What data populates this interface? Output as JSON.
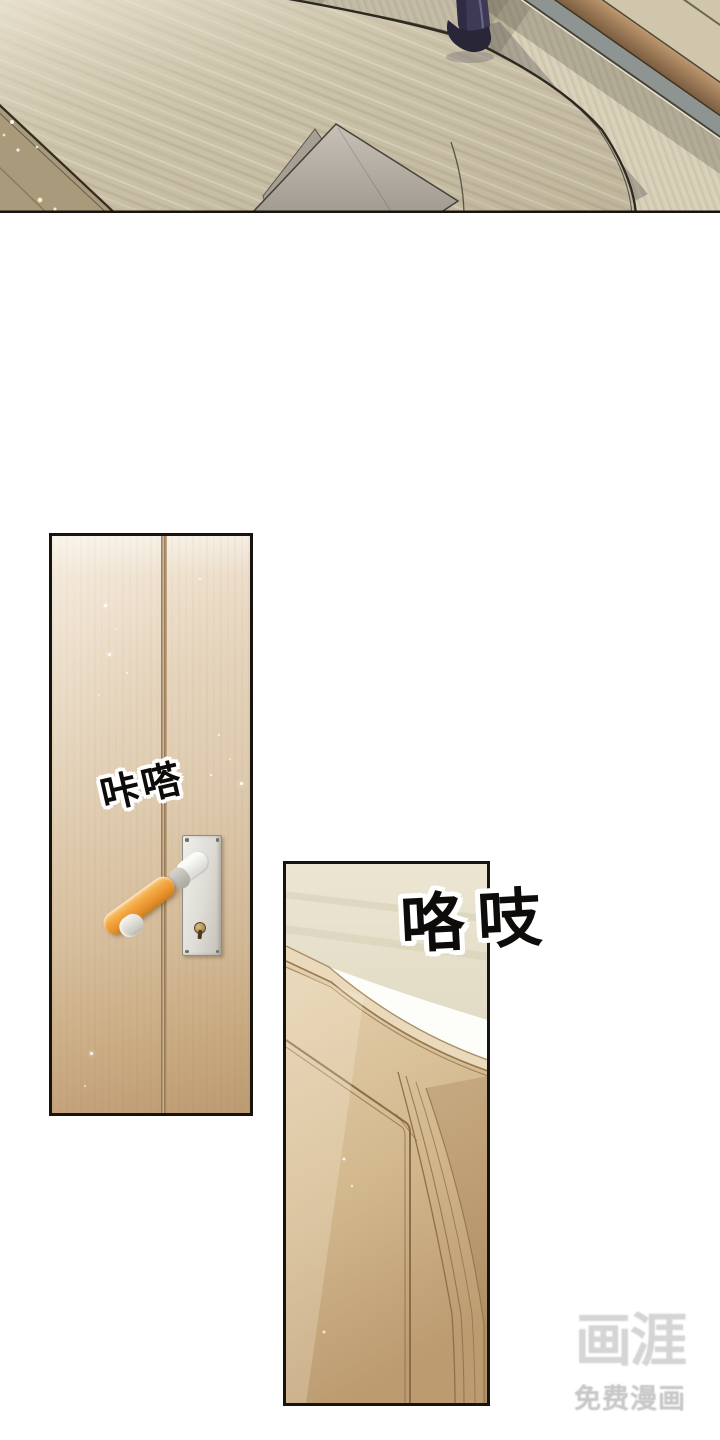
{
  "page": {
    "width": 720,
    "height": 1440,
    "background": "#ffffff"
  },
  "sfx": {
    "door_click": "咔嗒",
    "door_creak": "咯吱"
  },
  "watermark": {
    "logo": "画涯",
    "tagline": "免费漫画"
  },
  "palette": {
    "wood_floor": "#c6bda5",
    "tatami_mat": "#d6ceb6",
    "wood_strip_brown": "#a9835c",
    "gray_blue_band": "#8e9492",
    "dark_tatami_corner": "#a89a7b",
    "door_wood_light": "#e8d8c0",
    "door_wood_dark": "#c3a077",
    "handle_orange": "#f3a742",
    "plate_gray": "#dddbd4",
    "panel_border": "#17140f",
    "trousers_navy": "#3e3a56",
    "shoe_dark": "#292638",
    "paper_gray": "#b8b2a7",
    "wall_cream": "#e9e3d0",
    "sfx_ink": "#0d0c0a",
    "watermark_gray": "#d5d5d5"
  }
}
